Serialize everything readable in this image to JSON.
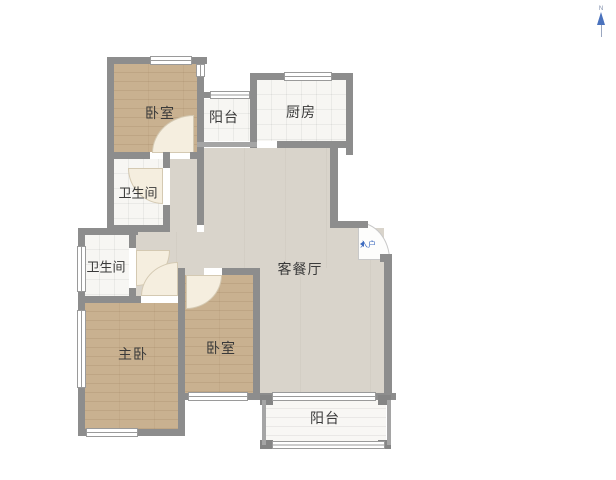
{
  "diagram": {
    "type": "apartment-floor-plan",
    "north_indicator": {
      "label": "N"
    },
    "entrance": {
      "label": "入户"
    },
    "rooms": [
      {
        "id": "bedroom-top",
        "label": "卧室",
        "type": "bedroom",
        "floor": "wood"
      },
      {
        "id": "balcony-top",
        "label": "阳台",
        "type": "balcony",
        "floor": "tile"
      },
      {
        "id": "kitchen",
        "label": "厨房",
        "type": "kitchen",
        "floor": "tile"
      },
      {
        "id": "bathroom-upper",
        "label": "卫生间",
        "type": "bathroom",
        "floor": "tile"
      },
      {
        "id": "bathroom-lower",
        "label": "卫生间",
        "type": "bathroom",
        "floor": "tile"
      },
      {
        "id": "living-dining",
        "label": "客餐厅",
        "type": "living-dining",
        "floor": "light"
      },
      {
        "id": "master-bedroom",
        "label": "主卧",
        "type": "bedroom",
        "floor": "wood"
      },
      {
        "id": "bedroom-bottom",
        "label": "卧室",
        "type": "bedroom",
        "floor": "wood"
      },
      {
        "id": "balcony-bottom",
        "label": "阳台",
        "type": "balcony",
        "floor": "tile"
      }
    ],
    "colors": {
      "wall": "#8d8d8d",
      "wood_floor": "#c9b190",
      "living_floor": "#d9d4cb",
      "tile_floor": "#f7f6f3",
      "door_arc": "#f5eedf",
      "accent_blue": "#3f6cc0",
      "label_text": "#3a3a3a",
      "background": "#ffffff"
    }
  }
}
